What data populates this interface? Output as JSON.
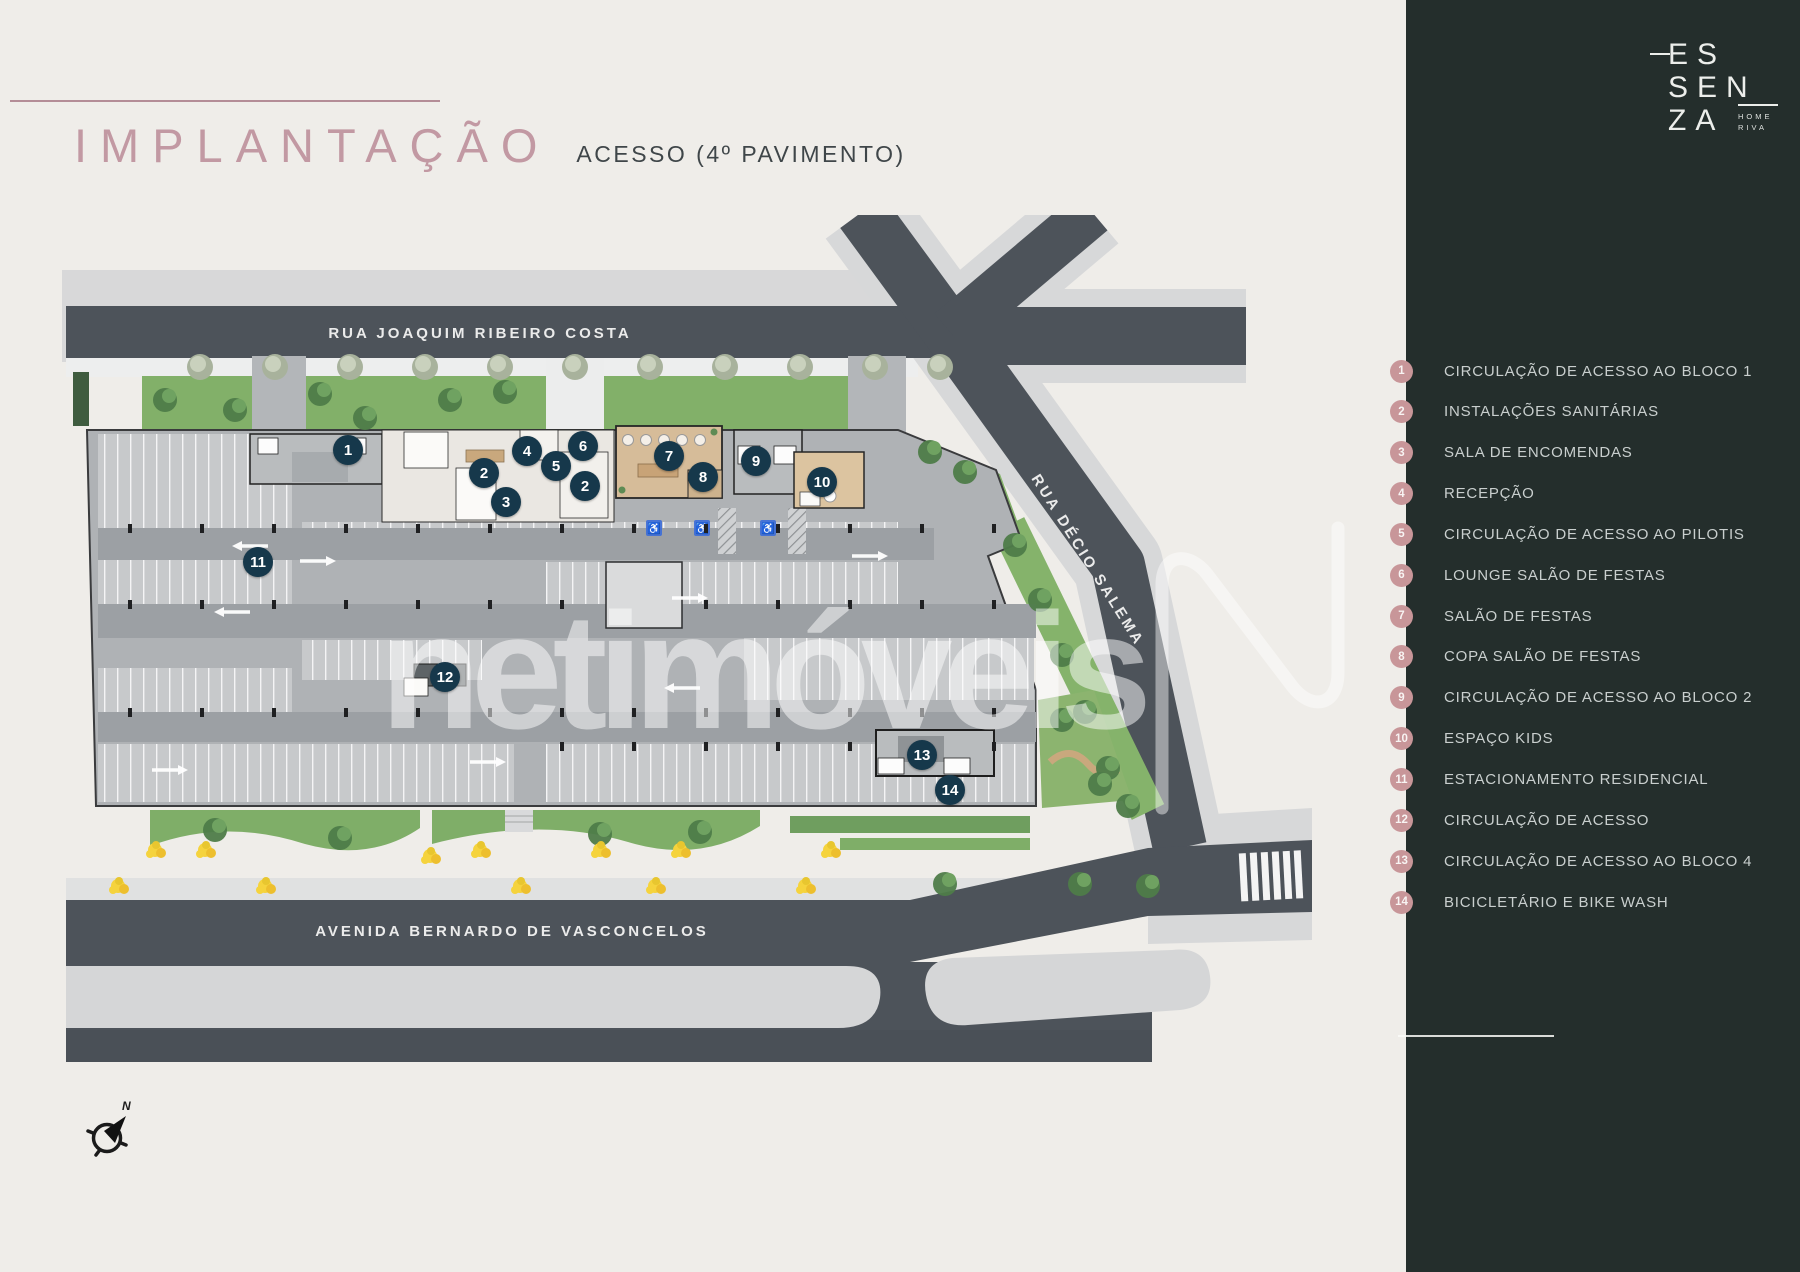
{
  "header": {
    "title": "IMPLANTAÇÃO",
    "subtitle": "ACESSO (4º PAVIMENTO)"
  },
  "brand": {
    "line1": "ES",
    "line2": "SEN",
    "line3": "ZA",
    "sub1": "HOME",
    "sub2": "RIVA"
  },
  "map": {
    "streets": {
      "top": "RUA JOAQUIM RIBEIRO COSTA",
      "bottom": "AVENIDA BERNARDO DE VASCONCELOS",
      "right": "RUA DÉCIO SALEMA"
    },
    "watermark": "netimóveis",
    "compass_label": "N",
    "markers": [
      {
        "n": "1",
        "x": 348,
        "y": 450
      },
      {
        "n": "2",
        "x": 484,
        "y": 473
      },
      {
        "n": "3",
        "x": 506,
        "y": 502
      },
      {
        "n": "4",
        "x": 527,
        "y": 451
      },
      {
        "n": "5",
        "x": 556,
        "y": 466
      },
      {
        "n": "2",
        "x": 585,
        "y": 486
      },
      {
        "n": "6",
        "x": 583,
        "y": 446
      },
      {
        "n": "7",
        "x": 669,
        "y": 456
      },
      {
        "n": "8",
        "x": 703,
        "y": 477
      },
      {
        "n": "9",
        "x": 756,
        "y": 461
      },
      {
        "n": "10",
        "x": 822,
        "y": 482
      },
      {
        "n": "11",
        "x": 258,
        "y": 562
      },
      {
        "n": "12",
        "x": 445,
        "y": 677
      },
      {
        "n": "13",
        "x": 922,
        "y": 755
      },
      {
        "n": "14",
        "x": 950,
        "y": 790
      }
    ]
  },
  "legend": {
    "items": [
      {
        "num": "1",
        "label": "CIRCULAÇÃO DE ACESSO AO BLOCO 1"
      },
      {
        "num": "2",
        "label": "INSTALAÇÕES SANITÁRIAS"
      },
      {
        "num": "3",
        "label": "SALA DE ENCOMENDAS"
      },
      {
        "num": "4",
        "label": "RECEPÇÃO"
      },
      {
        "num": "5",
        "label": "CIRCULAÇÃO DE ACESSO AO PILOTIS"
      },
      {
        "num": "6",
        "label": "LOUNGE SALÃO DE FESTAS"
      },
      {
        "num": "7",
        "label": "SALÃO DE FESTAS"
      },
      {
        "num": "8",
        "label": "COPA SALÃO DE FESTAS"
      },
      {
        "num": "9",
        "label": "CIRCULAÇÃO DE ACESSO AO BLOCO 2"
      },
      {
        "num": "10",
        "label": "ESPAÇO KIDS"
      },
      {
        "num": "11",
        "label": "ESTACIONAMENTO RESIDENCIAL"
      },
      {
        "num": "12",
        "label": "CIRCULAÇÃO DE ACESSO"
      },
      {
        "num": "13",
        "label": "CIRCULAÇÃO DE ACESSO AO BLOCO 4"
      },
      {
        "num": "14",
        "label": "BICICLETÁRIO E BIKE WASH"
      }
    ]
  },
  "colors": {
    "cream": "#EFEDE9",
    "sidebar": "#242E2C",
    "rose": "#C299A3",
    "rose_line": "#B48D97",
    "badge_pink": "#C89699",
    "marker_navy": "#16384B",
    "legend_text": "#C9CFCE"
  }
}
